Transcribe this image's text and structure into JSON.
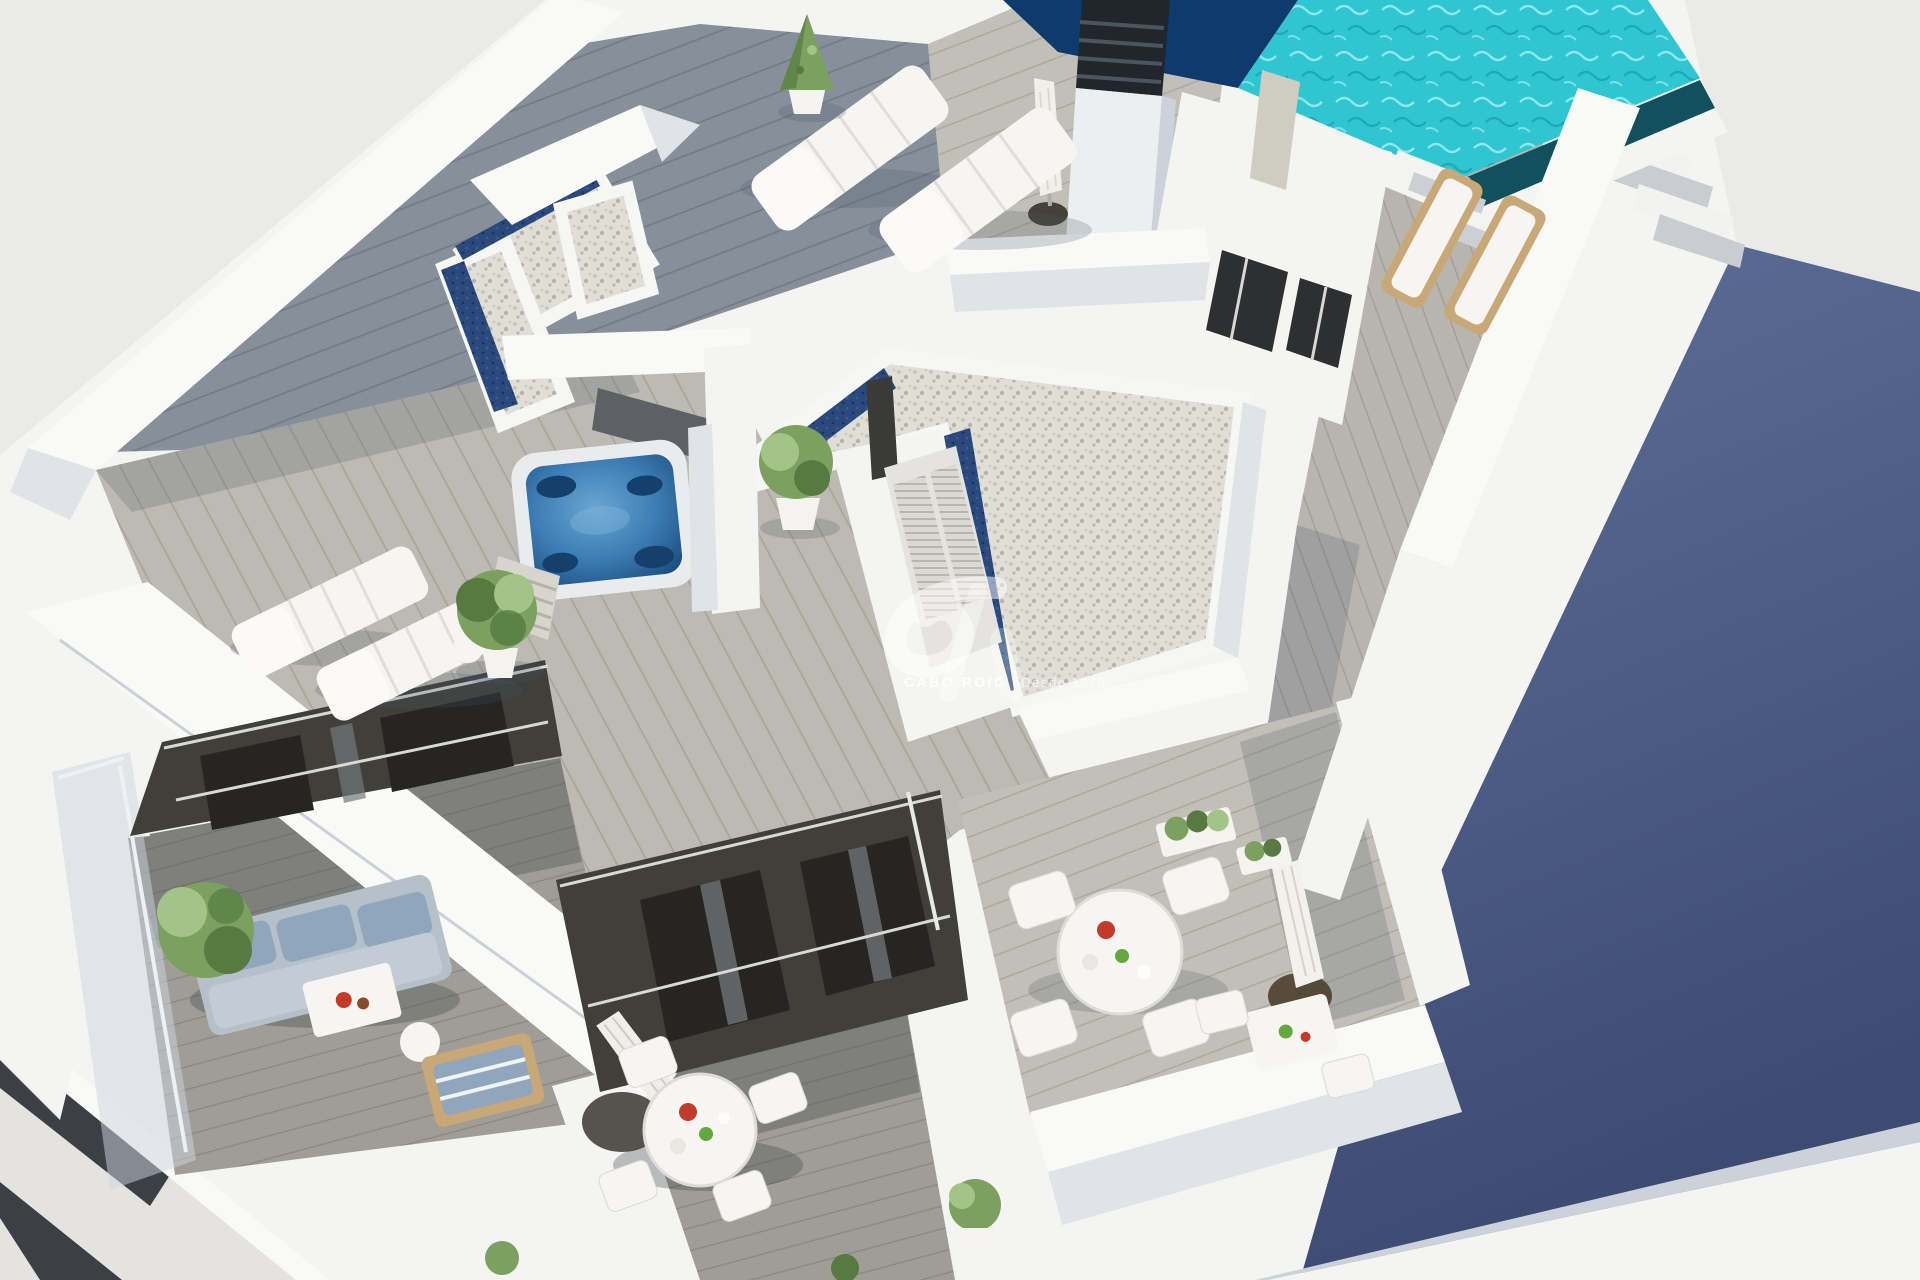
{
  "image": {
    "description": "Aerial 3D architectural render of a modern white rooftop penthouse level with swimming pool, jacuzzi, sun terraces and balconies",
    "elements": [
      "rooftop-pool",
      "jacuzzi",
      "gravel-roofs-with-glass-strips",
      "wood-deck-terraces",
      "sun-loungers",
      "parasols",
      "outdoor-dining-sets",
      "sofa-terrace",
      "stairs",
      "shadowed-side-wall"
    ]
  },
  "watermark": {
    "brand": "CABO ROIG",
    "tagline": "Desde 1970",
    "logo_icon": "cabo-roig-ribbon-monogram-icon"
  },
  "colors": {
    "bg": "#eaeae8",
    "bg2": "#e5e3df",
    "wallTop": "#f9f9f7",
    "wall": "#f4f4f2",
    "wallShade": "#e0e3e7",
    "wallShade2": "#cdd2da",
    "deckSlate": "#878f9a",
    "deckSlateLine": "#747c89",
    "deckLight": "#c2bfb8",
    "deckLightLine": "#adaaa2",
    "deckSteep": "#bdbab3",
    "deckSteepLine": "#a8a59c",
    "deckWalk": "#b8b5af",
    "deckWalkLine": "#a3a099",
    "deckMid": "#a09d96",
    "deckMidLine": "#8d8a83",
    "gravel": "#e0ded7",
    "gravelDot": "#b6b3aa",
    "navyStrip": "#2a4a7d",
    "pool": "#2fc5d1",
    "poolRipple": "#9feef0",
    "poolNavy": "#0f3a6d",
    "poolGutter": "#11505f",
    "jacuzzi": "#3d7db5",
    "jacuzziDeep": "#1c4f80",
    "shadowPlaneTop": "#5d7099",
    "shadowPlaneBottom": "#3d4a72",
    "facade": "#413f3a",
    "facadeDark": "#262523",
    "curtain": "#75777a",
    "plant": "#7ba05f",
    "plantDark": "#567a41",
    "plantLight": "#a3c487",
    "furniture": "#f6f5f2",
    "woodFurniture": "#c9a878",
    "sofa": "#b6c0c9",
    "sofaCushion": "#8fa6bd",
    "fruitRed": "#c43a2a",
    "fruitGreen": "#63a83f",
    "parasolBase": "#45403a",
    "louverPanel": "#dbd9d4",
    "frameWhite": "#e9e9e5"
  }
}
